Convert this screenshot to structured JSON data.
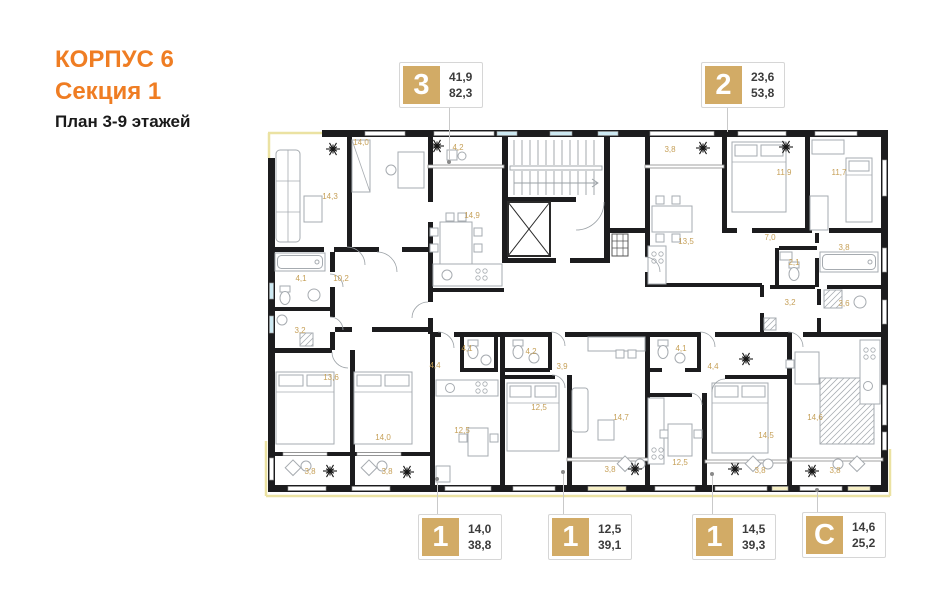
{
  "header": {
    "building": "КОРПУС 6",
    "section": "Секция 1",
    "floors": "План 3-9 этажей"
  },
  "colors": {
    "accent_orange": "#EF7D23",
    "badge_tan": "#D2AB66",
    "room_label_gold": "#C6A058",
    "wall_black": "#1c1c1e",
    "window_blue": "#CDE9F2",
    "facade_yellow": "#EBE2A2"
  },
  "markers": {
    "top": [
      {
        "type": "3",
        "line1": "41,9",
        "line2": "82,3"
      },
      {
        "type": "2",
        "line1": "23,6",
        "line2": "53,8"
      }
    ],
    "bottom": [
      {
        "type": "1",
        "line1": "14,0",
        "line2": "38,8"
      },
      {
        "type": "1",
        "line1": "12,5",
        "line2": "39,1"
      },
      {
        "type": "1",
        "line1": "14,5",
        "line2": "39,3"
      },
      {
        "type": "С",
        "line1": "14,6",
        "line2": "25,2"
      }
    ]
  },
  "room_labels": [
    {
      "value": "14,3",
      "x": 330,
      "y": 199
    },
    {
      "value": "14,0",
      "x": 361,
      "y": 145
    },
    {
      "value": "4,2",
      "x": 458,
      "y": 150
    },
    {
      "value": "14,9",
      "x": 472,
      "y": 218
    },
    {
      "value": "4,1",
      "x": 301,
      "y": 281
    },
    {
      "value": "10,2",
      "x": 341,
      "y": 281
    },
    {
      "value": "3,2",
      "x": 300,
      "y": 333
    },
    {
      "value": "13,6",
      "x": 331,
      "y": 380
    },
    {
      "value": "14,0",
      "x": 383,
      "y": 440
    },
    {
      "value": "3,8",
      "x": 310,
      "y": 474
    },
    {
      "value": "3,8",
      "x": 387,
      "y": 474
    },
    {
      "value": "4,4",
      "x": 435,
      "y": 368
    },
    {
      "value": "4,1",
      "x": 467,
      "y": 351
    },
    {
      "value": "12,5",
      "x": 462,
      "y": 433
    },
    {
      "value": "4,2",
      "x": 531,
      "y": 354
    },
    {
      "value": "3,9",
      "x": 562,
      "y": 369
    },
    {
      "value": "12,5",
      "x": 539,
      "y": 410
    },
    {
      "value": "14,7",
      "x": 621,
      "y": 420
    },
    {
      "value": "3,8",
      "x": 610,
      "y": 472
    },
    {
      "value": "3,8",
      "x": 670,
      "y": 152
    },
    {
      "value": "13,5",
      "x": 686,
      "y": 244
    },
    {
      "value": "7,0",
      "x": 770,
      "y": 240
    },
    {
      "value": "2,1",
      "x": 794,
      "y": 265
    },
    {
      "value": "11,9",
      "x": 784,
      "y": 175
    },
    {
      "value": "11,7",
      "x": 839,
      "y": 175
    },
    {
      "value": "3,8",
      "x": 844,
      "y": 250
    },
    {
      "value": "3,2",
      "x": 790,
      "y": 305
    },
    {
      "value": "3,6",
      "x": 844,
      "y": 306
    },
    {
      "value": "4,1",
      "x": 681,
      "y": 351
    },
    {
      "value": "4,4",
      "x": 713,
      "y": 369
    },
    {
      "value": "12,5",
      "x": 680,
      "y": 465
    },
    {
      "value": "14,5",
      "x": 766,
      "y": 438
    },
    {
      "value": "3,8",
      "x": 760,
      "y": 473
    },
    {
      "value": "14,6",
      "x": 815,
      "y": 420
    },
    {
      "value": "3,8",
      "x": 835,
      "y": 473
    }
  ]
}
